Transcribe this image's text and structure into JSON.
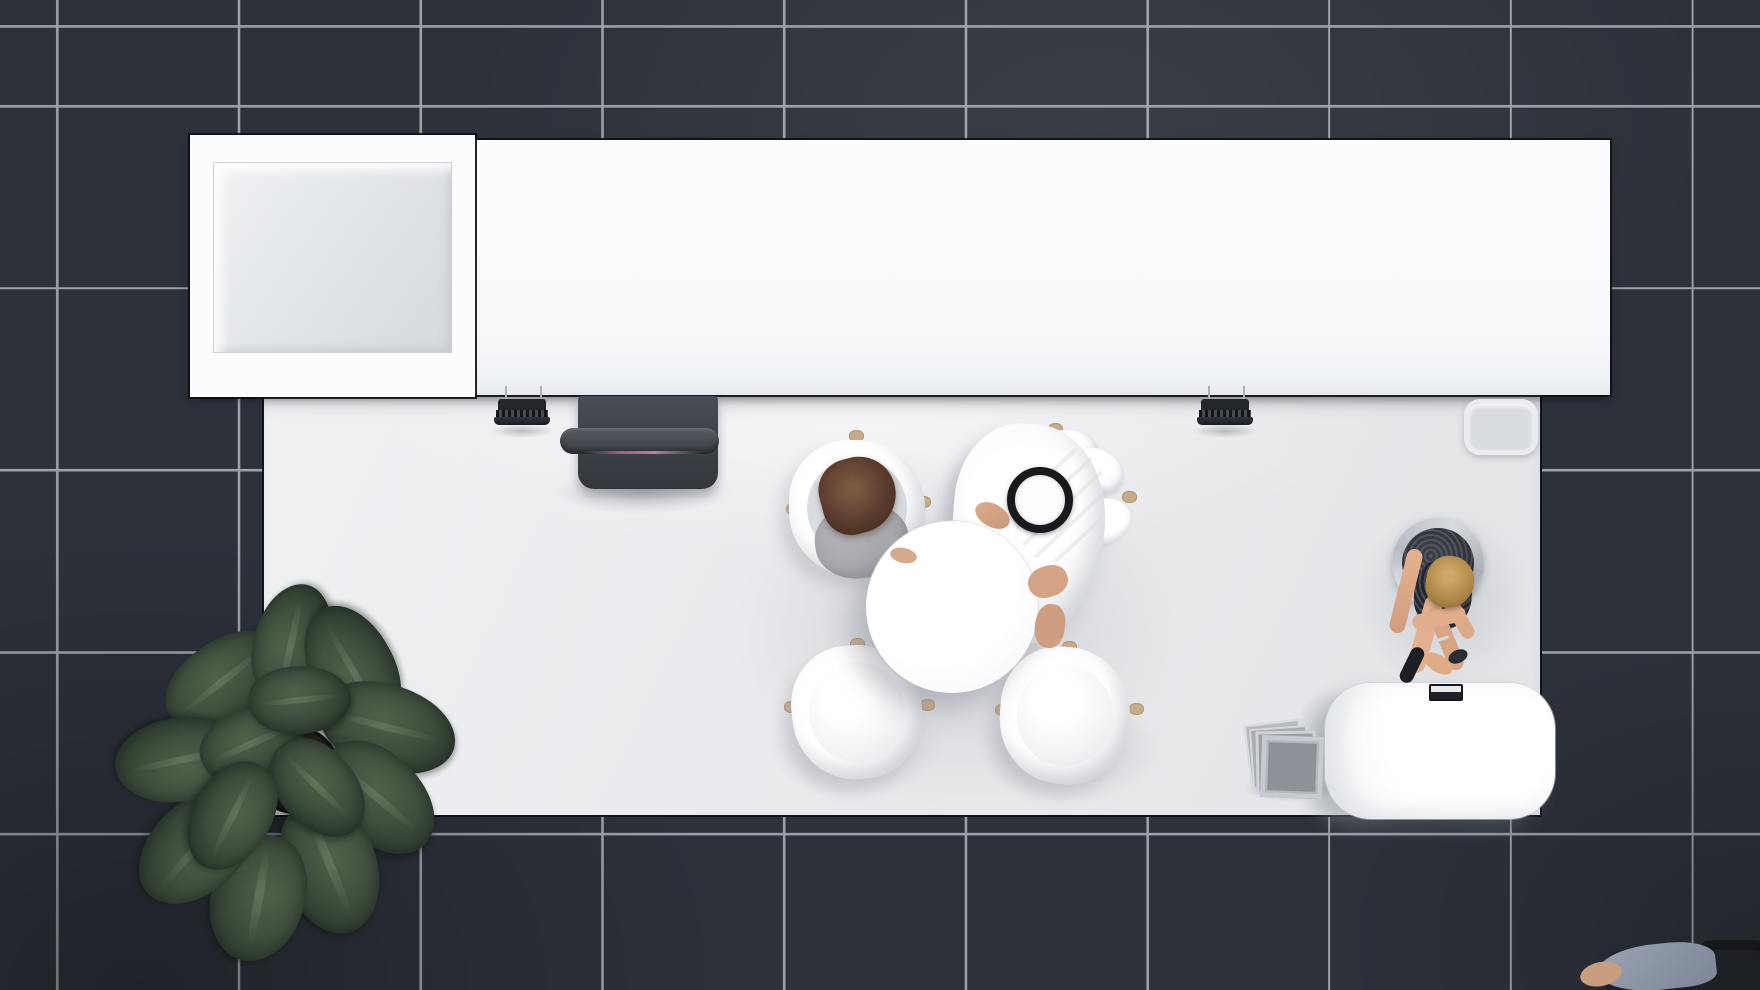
{
  "meta": {
    "view": "top-down 3d render of an exhibition booth on dark tiled floor",
    "visible_text": ""
  },
  "palette": {
    "tile": "#2d313a",
    "grout": "#9aa1a8",
    "wall_white": "#fbfcfd",
    "booth_floor": "#e9eaed",
    "screen_dark": "#3a3f46",
    "accent_pink": "#b06a8f",
    "wood": "#c6ad8a",
    "skin": "#d5a98b",
    "hair_brown": "#5f4030",
    "hair_blonde": "#cfa765",
    "leaf_green": "#3a473a",
    "chrome": "#c7cbd1",
    "panel_gray": "#9da0a6",
    "outline_dark": "#121419"
  },
  "scene": {
    "floor": {
      "tile_count_x": 10,
      "tile_count_y": 6,
      "tile_size_px": 182,
      "grout_color": "#9aa1a8"
    },
    "structures": [
      {
        "name": "back-wall-counter",
        "desc": "long white wall/counter band across the top"
      },
      {
        "name": "storage-room",
        "desc": "white block with open square interior niche, top left"
      },
      {
        "name": "booth-floor-mat",
        "desc": "large white rectangular booth floor"
      }
    ],
    "furniture": [
      {
        "name": "media-screen",
        "desc": "dark flat screen unit with horizontal bar and pink accent line"
      },
      {
        "name": "spotlights",
        "count": 2,
        "desc": "black ribbed track lights hanging from counter edge"
      },
      {
        "name": "side-stool",
        "desc": "light gray rounded-square stool at right edge of counter"
      },
      {
        "name": "round-table",
        "desc": "white circular meeting table"
      },
      {
        "name": "chairs",
        "count": 4,
        "desc": "glossy white shell chairs with wooden leg tips, two occupied"
      },
      {
        "name": "hostess-round-chair",
        "desc": "chrome-rimmed round chair with dark upholstery"
      },
      {
        "name": "reception-desk",
        "desc": "white rounded reception counter with small tray on edge"
      },
      {
        "name": "brochure-stack",
        "count": 4,
        "desc": "leaning gray display panels beside desk"
      },
      {
        "name": "floor-plant",
        "desc": "large dark-green leafy plant in black pot, bottom left"
      }
    ],
    "people": [
      {
        "name": "visitor-a",
        "desc": "seated person, brown hair, gray top, arms on table"
      },
      {
        "name": "visitor-b",
        "desc": "seated man in white kandura with black agal headband"
      },
      {
        "name": "hostess",
        "desc": "blonde woman in dark dress seated, legs crossed toward desk"
      },
      {
        "name": "corner-visitor",
        "desc": "partially visible person at bottom-right corner"
      }
    ]
  }
}
